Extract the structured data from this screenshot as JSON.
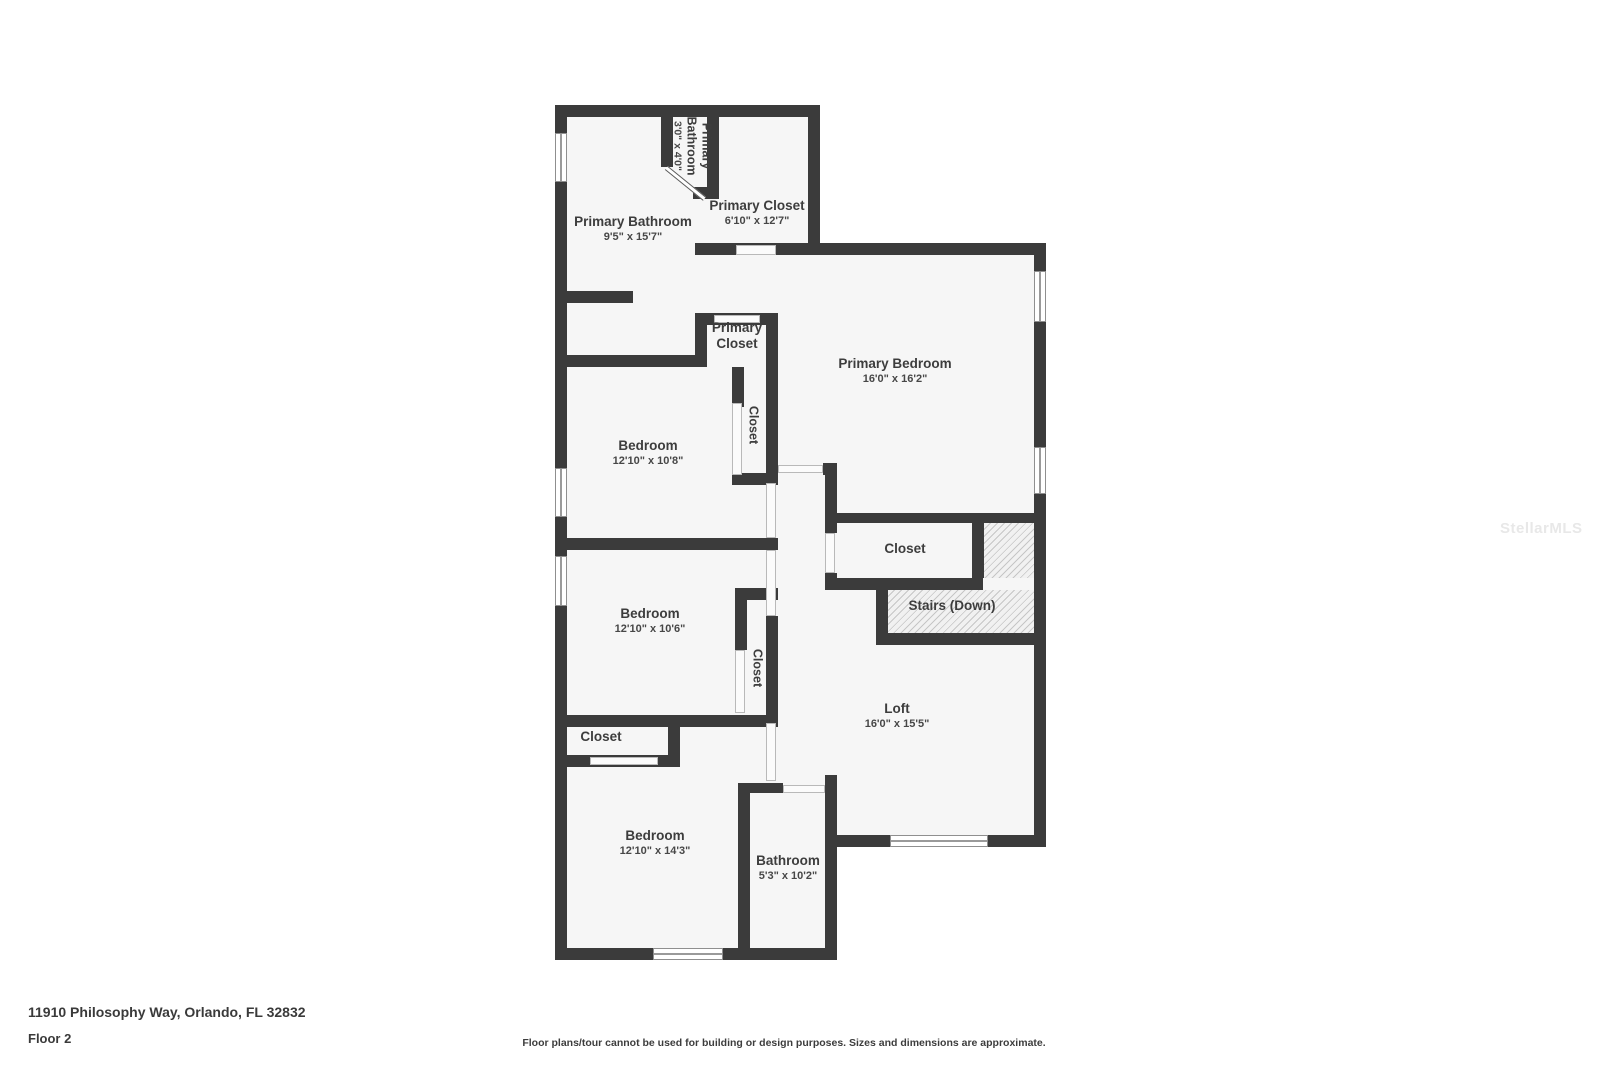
{
  "page": {
    "background": "#ffffff"
  },
  "plan": {
    "wall_color": "#3b3b3b",
    "floor_color": "#f6f6f6",
    "rooms": {
      "wc": {
        "name": "Primary Bathroom",
        "dims": "3'0\" x 4'0\""
      },
      "primary_bathroom": {
        "name": "Primary Bathroom",
        "dims": "9'5\" x 15'7\""
      },
      "primary_closet_large": {
        "name": "Primary Closet",
        "dims": "6'10\" x 12'7\""
      },
      "primary_closet_small": {
        "name": "Primary Closet"
      },
      "primary_bedroom": {
        "name": "Primary Bedroom",
        "dims": "16'0\" x 16'2\""
      },
      "bedroom1": {
        "name": "Bedroom",
        "dims": "12'10\" x 10'8\""
      },
      "closet1": {
        "name": "Closet"
      },
      "closet_stairs": {
        "name": "Closet"
      },
      "stairs": {
        "name": "Stairs (Down)"
      },
      "bedroom2": {
        "name": "Bedroom",
        "dims": "12'10\" x 10'6\""
      },
      "closet2": {
        "name": "Closet"
      },
      "closet3": {
        "name": "Closet"
      },
      "bedroom3": {
        "name": "Bedroom",
        "dims": "12'10\" x 14'3\""
      },
      "bathroom": {
        "name": "Bathroom",
        "dims": "5'3\" x 10'2\""
      },
      "loft": {
        "name": "Loft",
        "dims": "16'0\" x 15'5\""
      }
    }
  },
  "watermark": {
    "text": "StellarMLS",
    "color": "#e8e8e8"
  },
  "footer": {
    "address": "11910 Philosophy Way, Orlando, FL 32832",
    "floor_label": "Floor 2",
    "disclaimer": "Floor plans/tour cannot be used for building or design purposes. Sizes and dimensions are approximate."
  }
}
